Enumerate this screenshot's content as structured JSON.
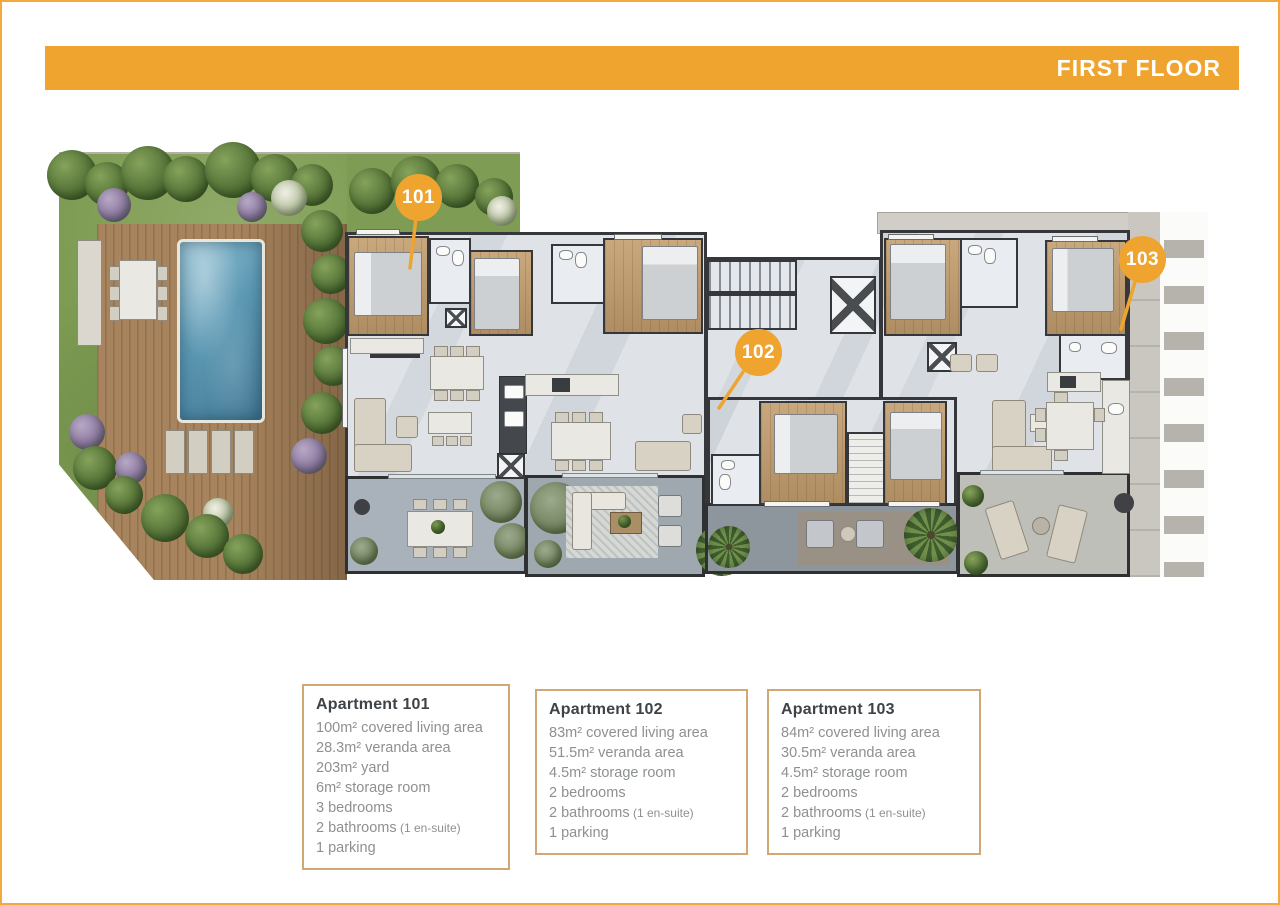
{
  "header": {
    "title": "FIRST FLOOR"
  },
  "plan": {
    "badges": [
      {
        "label": "101"
      },
      {
        "label": "102"
      },
      {
        "label": "103"
      }
    ]
  },
  "apartments": [
    {
      "title": "Apartment 101",
      "lines": [
        {
          "text": "100m² covered living area"
        },
        {
          "text": "28.3m² veranda area"
        },
        {
          "text": "203m² yard"
        },
        {
          "text": "6m² storage room"
        },
        {
          "text": "3 bedrooms"
        },
        {
          "text": "2 bathrooms",
          "note": "(1 en-suite)"
        },
        {
          "text": "1 parking"
        }
      ]
    },
    {
      "title": "Apartment 102",
      "lines": [
        {
          "text": "83m² covered living area"
        },
        {
          "text": "51.5m² veranda area"
        },
        {
          "text": "4.5m² storage room"
        },
        {
          "text": "2 bedrooms"
        },
        {
          "text": "2 bathrooms",
          "note": "(1 en-suite)"
        },
        {
          "text": "1 parking"
        }
      ]
    },
    {
      "title": "Apartment 103",
      "lines": [
        {
          "text": "84m² covered living area"
        },
        {
          "text": "30.5m² veranda area"
        },
        {
          "text": "4.5m² storage room"
        },
        {
          "text": "2 bedrooms"
        },
        {
          "text": "2 bathrooms",
          "note": "(1 en-suite)"
        },
        {
          "text": "1 parking"
        }
      ]
    }
  ],
  "colors": {
    "accent_orange": "#EFA42F",
    "info_box_border": "#D2A776",
    "grass_green": "#7E9C53",
    "deck_brown": "#A8845E",
    "pool_blue": "#5E9AB5",
    "wood_floor": "#C2A077",
    "wall_dark": "#35373A"
  }
}
